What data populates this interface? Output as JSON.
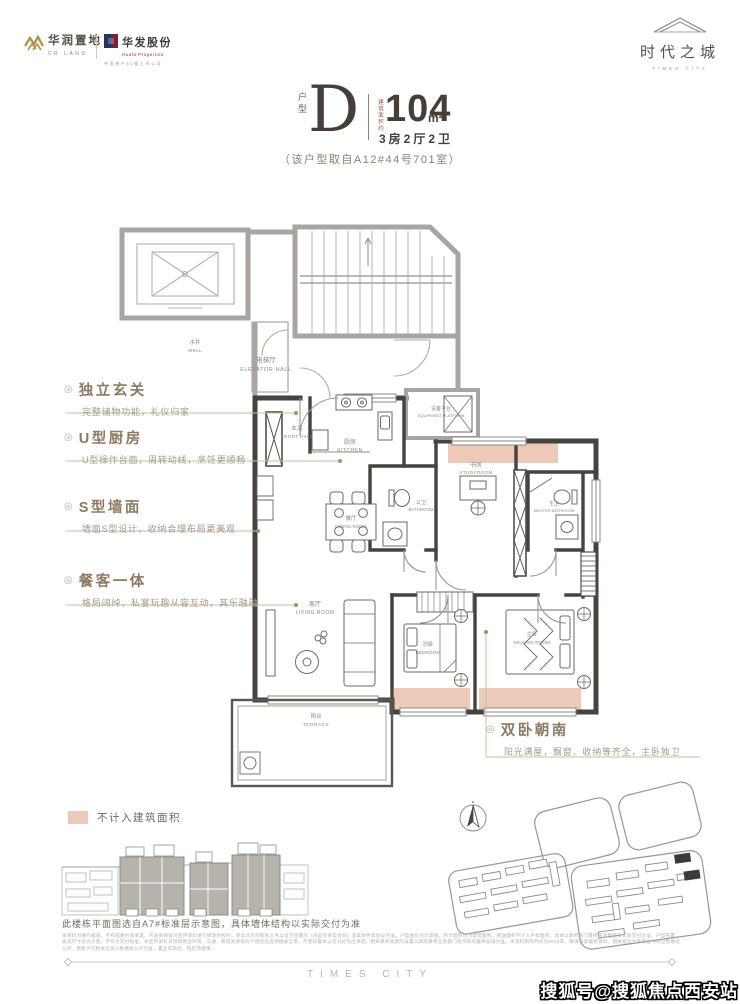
{
  "header": {
    "cr_logo": {
      "name": "华润置地",
      "sub": "CR LAND"
    },
    "huafa_logo": {
      "name": "华发股份",
      "sub": "Huafa Properties",
      "tagline": "中国地产50强上市公司"
    },
    "times_logo": {
      "name": "时代之城",
      "sub": "TIMES CITY"
    }
  },
  "title": {
    "unit_label": "户型",
    "unit": "D",
    "area_prefix": "建筑面积约",
    "area": "104",
    "area_unit": "m²",
    "rooms": "3房2厅2卫",
    "source_note": "（该户型取自A12#44号701室）"
  },
  "annotations": [
    {
      "title": "独立玄关",
      "desc": "完整储物功能，礼仪归家"
    },
    {
      "title": "U型厨房",
      "desc": "U型操作台面，周转动线，烹饪更顺畅"
    },
    {
      "title": "S型墙面",
      "desc": "墙面S型设计，收纳合理布局更美观"
    },
    {
      "title": "餐客一体",
      "desc": "格局阔绰，私宴玩趣从容互动，其乐融融"
    }
  ],
  "annotation_right": {
    "title": "双卧朝南",
    "desc": "阳光满屋，飘窗、收纳等齐全，主卧独卫"
  },
  "plan": {
    "rooms": [
      {
        "cn": "水井",
        "en": "WELL"
      },
      {
        "cn": "电梯厅",
        "en": "ELEVATOR HALL"
      },
      {
        "cn": "玄关",
        "en": "FRONT HALL"
      },
      {
        "cn": "厨房",
        "en": "KITCHEN"
      },
      {
        "cn": "设备平台",
        "en": "EQUIPMENT PLATFORM"
      },
      {
        "cn": "书房",
        "en": "STUDYROOM"
      },
      {
        "cn": "公卫",
        "en": "BATHROOM"
      },
      {
        "cn": "主卫",
        "en": "MASTER BATHROOM"
      },
      {
        "cn": "餐厅",
        "en": "DINING ROOM"
      },
      {
        "cn": "客厅",
        "en": "LIVING ROOM"
      },
      {
        "cn": "次卧",
        "en": "BEDROOM"
      },
      {
        "cn": "主卧",
        "en": "MASTER ROOM"
      },
      {
        "cn": "阳台",
        "en": "TERRACE"
      }
    ],
    "highlight_color": "#ecc9b8"
  },
  "legend": {
    "label": "不计入建筑面积"
  },
  "key_plan_caption": "此楼栋平面图选自A7#标准层示意图，具体墙体结构以实际交付为准",
  "disclaimer": {
    "lines": "本资料为要约邀请，不构成要约或承诺。开发商保留对宣传资料进行修改的权利，买卖双方的权利义务以双方签署的《商品房买卖合同》及其附件等协议为准。户型图仅为示意图，所示面积均为建筑面积，赠送面积不计入产权面积，具体以政府部门最终核准图纸及实际交付为准。户型布置、家具尺寸仅为示意，不作为交付标准。本宣传资料对项目周边环境、交通、教育资源等的介绍旨在提供相关信息，不意味着本公司对此作出承诺。相关教育资源的设置以政府教育主管部门及学校的最终安排为准。本资料制作时间为2024年，敬请留意最新资料。相关批准文件及证书详见售楼处公示。预售许可相关信息以售楼处公示为准，置业有风险，购房须谨慎。"
  },
  "footer": {
    "brand": "TIMES CITY",
    "watermark": "搜狐号@搜狐焦点西安站"
  }
}
